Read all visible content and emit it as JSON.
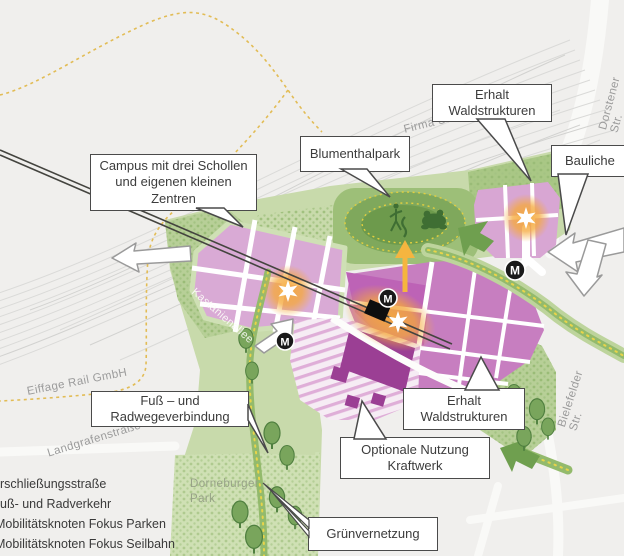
{
  "callouts": {
    "campus": "Campus mit drei Schollen\nund eigenen kleinen\nZentren",
    "blumenthalpark": "Blumenthalpark",
    "erhalt_wald_top": "Erhalt\nWaldstrukturen",
    "bauliche": "Bauliche",
    "fuss_radweg": "Fuß – und\nRadwegeverbindung",
    "erhalt_wald_bottom": "Erhalt\nWaldstrukturen",
    "optionale_kraftwerk": "Optionale Nutzung\nKraftwerk",
    "gruenvernetzung": "Grünvernetzung"
  },
  "map_labels": {
    "firma_stadl": "Firma Stadl",
    "dorstener_str": "Dorstener Str.",
    "bielefelder_str": "Bielefelder Str.",
    "eiffage_rail": "Eiffage Rail GmbH",
    "landgrafenstrasse": "Landgrafenstraße",
    "kastanienallee": "Kastanienallee",
    "dorneburger_park": "Dorneburger\nPark"
  },
  "legend": {
    "items": [
      {
        "label": "rschließungsstraße"
      },
      {
        "label": "uß- und Radverkehr"
      },
      {
        "label": "Mobilitätsknoten Fokus Parken"
      },
      {
        "label": "Mobilitätsknoten Fokus Seilbahn"
      }
    ]
  },
  "markers": {
    "mobility_label": "M"
  },
  "colors": {
    "site_boundary": "#e2bc55",
    "block_pink": "#d9aad5",
    "block_magenta": "#c77ec0",
    "kraftwerk_purple": "#9b3f94",
    "green_light": "#c8daab",
    "green_texture": "#b7cf97",
    "park_green": "#a3c47e",
    "route_green": "#93ba6c",
    "route_dots_yellow": "#e8d44a",
    "highlight_orange": "#f5a93b",
    "marker_black": "#1a1a1a",
    "callout_border": "#4a4a4a"
  }
}
